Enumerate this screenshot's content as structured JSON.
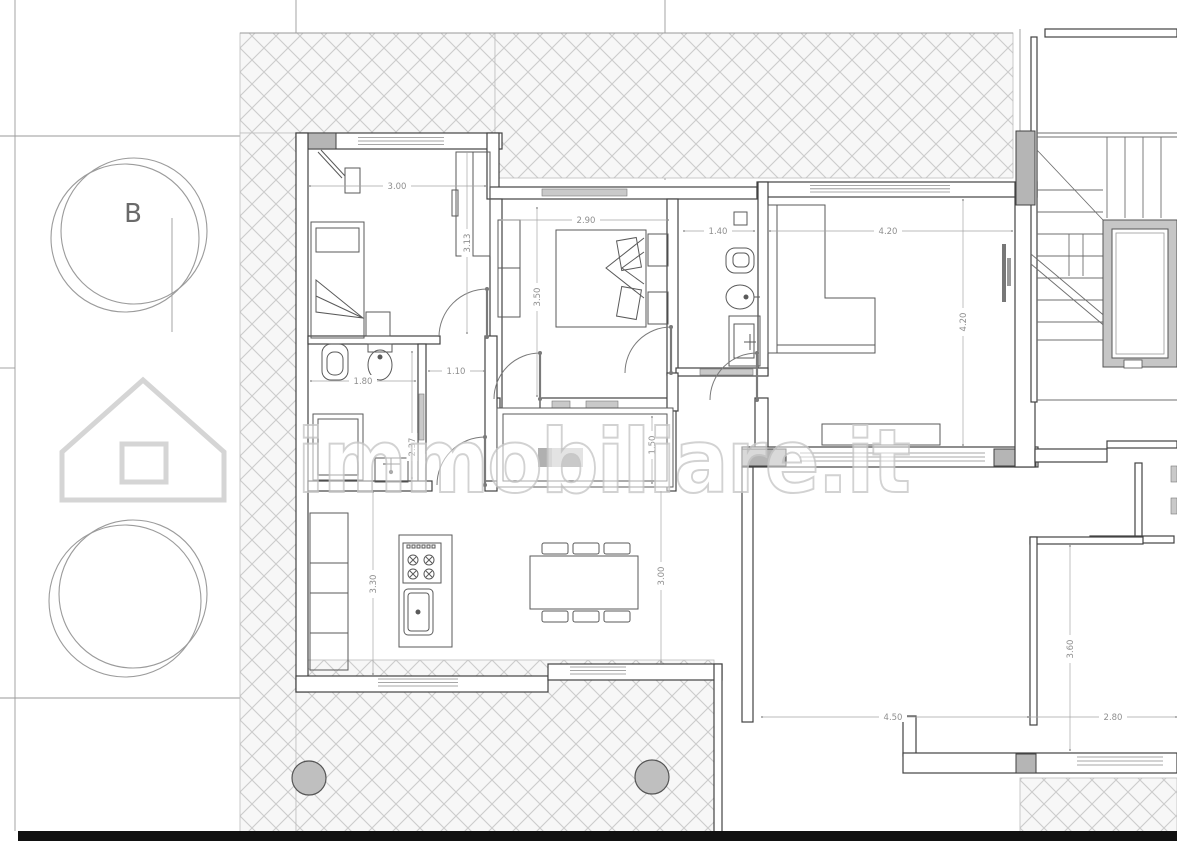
{
  "plan": {
    "watermark_text": "immobiliare.it",
    "tree_label": "B"
  },
  "dimensions": {
    "bedroom1_width": "3.00",
    "bedroom1_depth": "3.13",
    "bedroom2_width": "2.90",
    "bedroom2_depth": "3.50",
    "bath2_width": "1.40",
    "living_width": "4.20",
    "living_depth": "4.20",
    "bath1_width": "1.80",
    "hallway_width": "1.10",
    "bath1_depth": "2.37",
    "loggia_depth": "1.50",
    "kitchen_depth_left": "3.30",
    "kitchen_depth_right": "3.00",
    "adjacent_room_width": "4.50",
    "adjacent_room2_width": "2.80",
    "adjacent_room2_depth": "3.60"
  },
  "colors": {
    "wall": "#424242",
    "fixture": "#5a5a5a",
    "dimension_text": "#8f8f8f",
    "hatch_line": "#cccccc",
    "pillar_fill": "#b5b5b5",
    "sliding_door_fill": "#c9c9c9",
    "column_fill": "#bfbfbf",
    "footer_bar": "#111111",
    "watermark_stroke": "#c8c8c8"
  }
}
